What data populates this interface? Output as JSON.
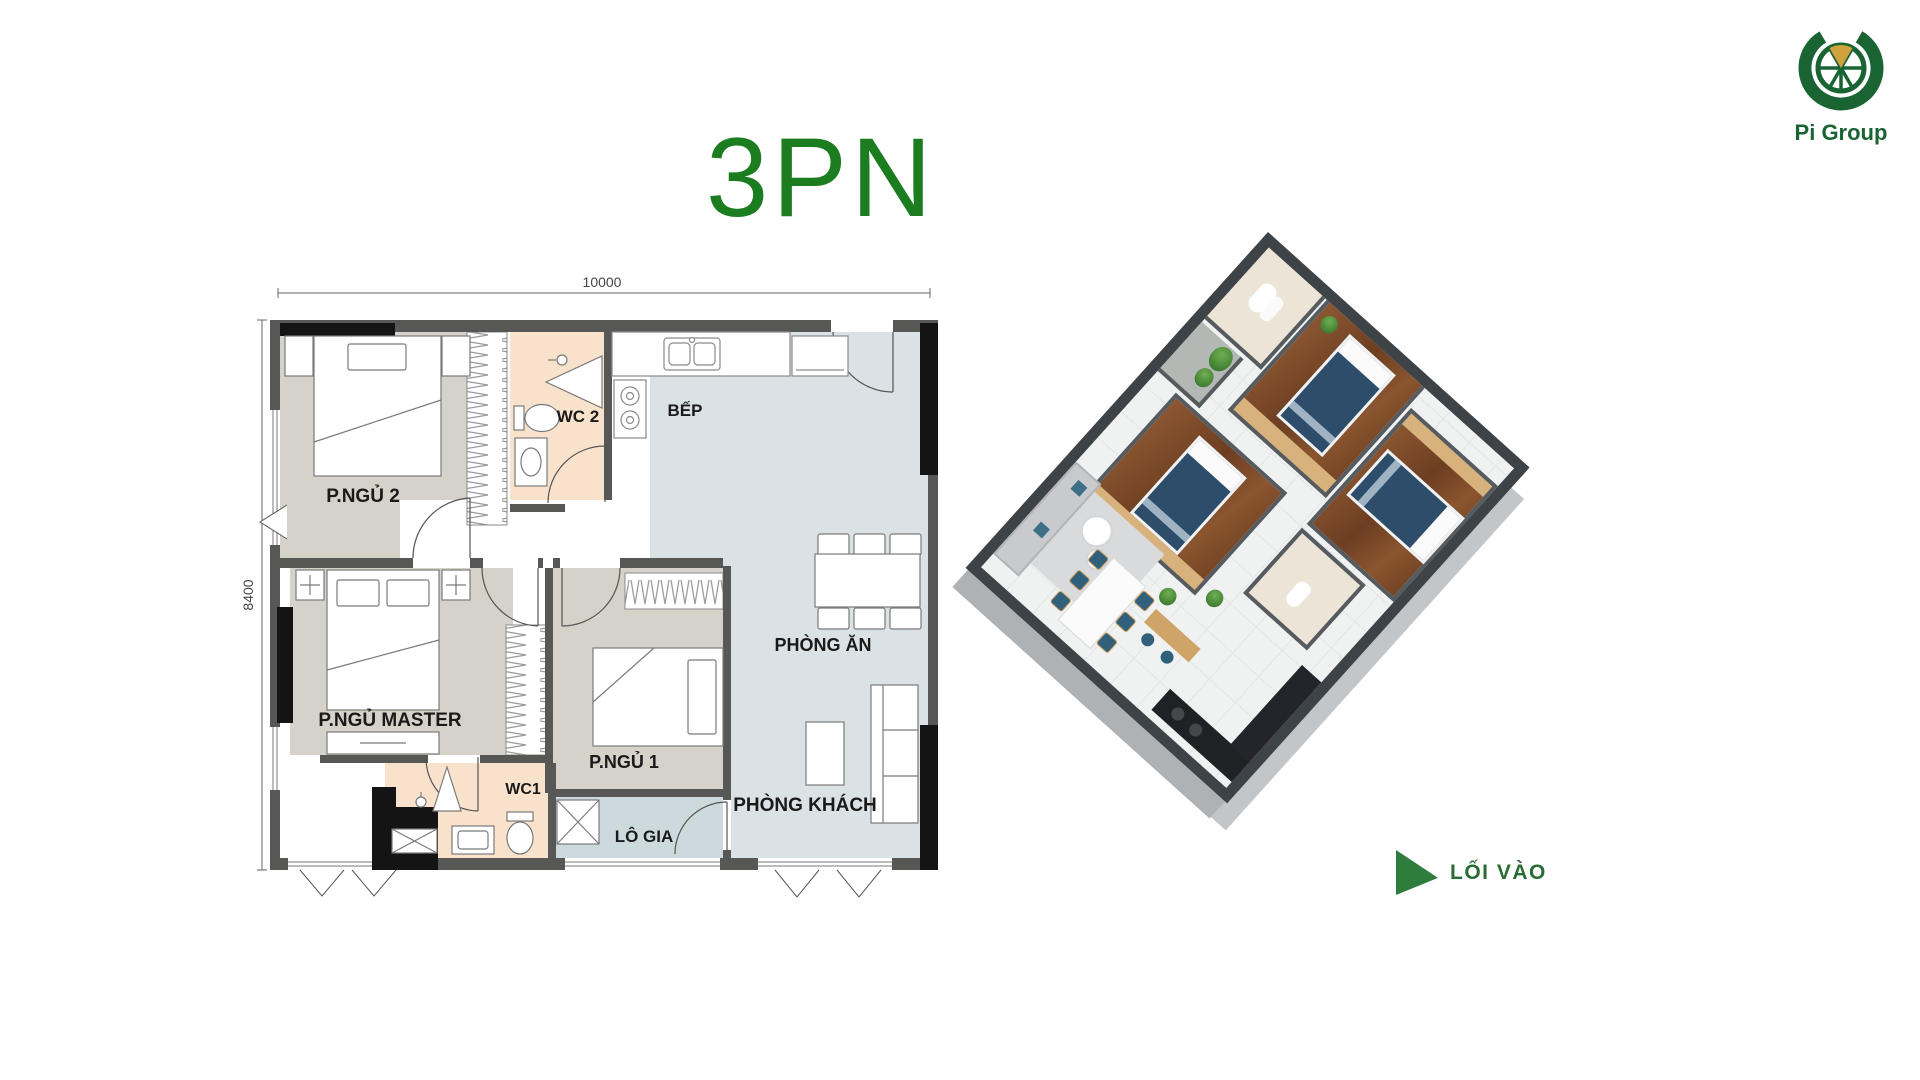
{
  "title": "3PN",
  "logo": {
    "brand": "Pi Group"
  },
  "plan2d": {
    "dim_width": "10000",
    "dim_height": "8400",
    "labels": {
      "bedroom2": "P.NGỦ 2",
      "wc2": "WC 2",
      "kitchen": "BẾP",
      "dining": "PHÒNG ĂN",
      "master": "P.NGỦ MASTER",
      "bedroom1": "P.NGỦ 1",
      "wc1": "WC1",
      "loggia": "LÔ GIA",
      "living": "PHÒNG KHÁCH"
    }
  },
  "plan3d": {
    "entrance": "LỐI VÀO"
  },
  "colors": {
    "title_green": "#1b7d1f",
    "logo_green": "#1a6434",
    "logo_gold": "#cfa23c",
    "entrance_green": "#2e7d3c",
    "wall": "#575756",
    "column": "#141414",
    "floor_bedroom": "#d5d2ca",
    "floor_wc": "#f9e2cb",
    "floor_main": "#dbe2e5",
    "floor_loggia": "#ccdade",
    "wood_3d": "#7c4a28",
    "bed_3d": "#2d4d6b"
  }
}
